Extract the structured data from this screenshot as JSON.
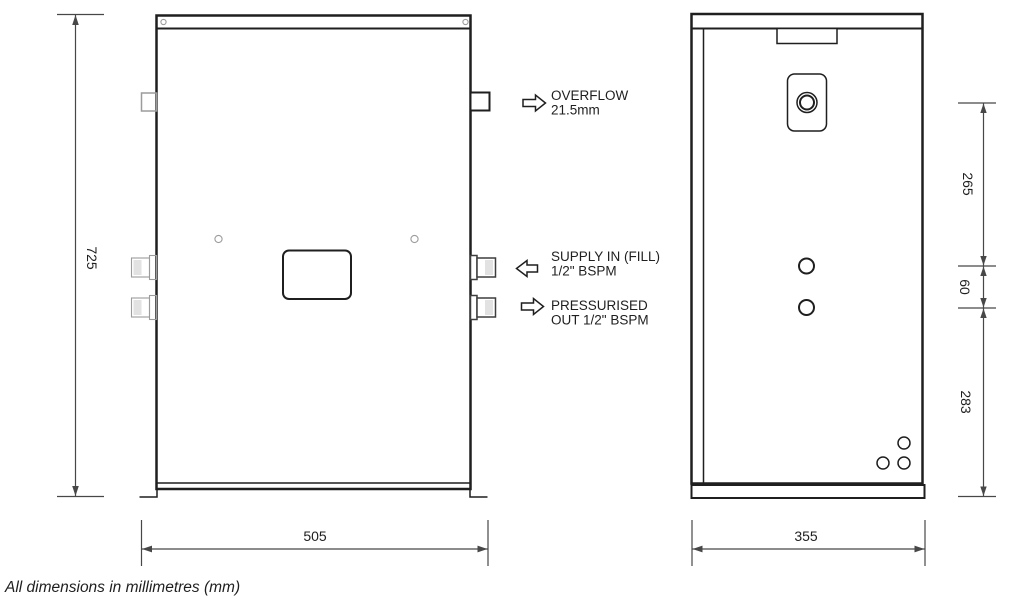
{
  "note": "All dimensions in millimetres (mm)",
  "colors": {
    "line": "#1f1f1f",
    "gray": "#9c9c9c",
    "shade": "#e2e2e2",
    "dim": "#474747",
    "bg": "#ffffff"
  },
  "dims": {
    "front_height": "725",
    "front_width": "505",
    "side_width": "355",
    "side_chain": [
      "265",
      "60",
      "283"
    ]
  },
  "callouts": {
    "overflow": {
      "line1": "OVERFLOW",
      "line2": "21.5mm"
    },
    "supply": {
      "line1": "SUPPLY IN (FILL)",
      "line2": "1/2\" BSPM"
    },
    "pressurised": {
      "line1": "PRESSURISED",
      "line2": "OUT 1/2\" BSPM"
    }
  }
}
